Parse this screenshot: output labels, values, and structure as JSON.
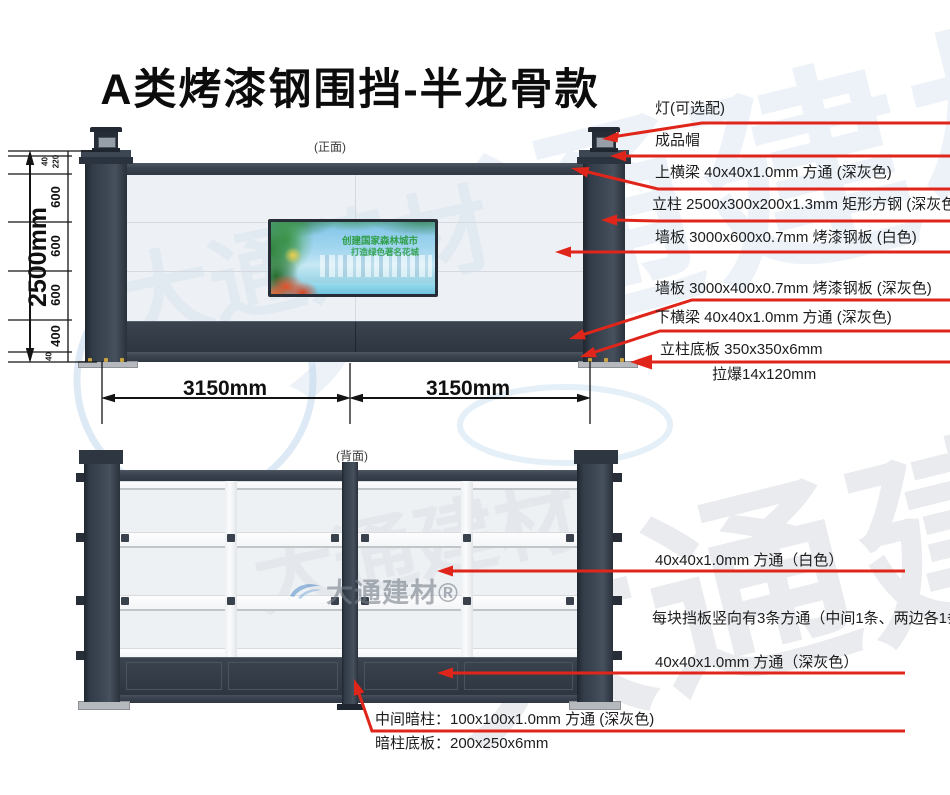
{
  "title": "A类烤漆钢围挡-半龙骨款",
  "watermark_text": "大通建材",
  "front": {
    "caption": "(正面)",
    "dim_total": "2500mm",
    "segments": {
      "top40": "40",
      "top220": "220",
      "mid600a": "600",
      "mid600b": "600",
      "mid600c": "600",
      "low400": "400",
      "bot40": "40"
    },
    "panel_w1": "3150mm",
    "panel_w2": "3150mm",
    "labels": {
      "lamp": "灯(可选配)",
      "cap": "成品帽",
      "top_beam": "上横梁 40x40x1.0mm 方通 (深灰色)",
      "post": "立柱 2500x300x200x1.3mm 矩形方钢 (深灰色)",
      "wall_white": "墙板 3000x600x0.7mm 烤漆钢板 (白色)",
      "wall_gray": "墙板 3000x400x0.7mm 烤漆钢板 (深灰色)",
      "bottom_beam": "下横梁 40x40x1.0mm 方通 (深灰色)",
      "base_plate": "立柱底板 350x350x6mm",
      "anchor": "拉爆14x120mm"
    },
    "billboard": {
      "line1": "创建国家森林城市",
      "line2": "打造绿色著名花城"
    }
  },
  "back": {
    "caption": "(背面)",
    "labels": {
      "tube_white": "40x40x1.0mm 方通（白色）",
      "tube_note": "每块挡板竖向有3条方通（中间1条、两边各1条）",
      "tube_gray": "40x40x1.0mm 方通（深灰色）",
      "hidden_post": "中间暗柱：100x100x1.0mm 方通 (深灰色)",
      "hidden_post_base": "暗柱底板：200x250x6mm"
    },
    "logo": "大通建材®"
  },
  "colors": {
    "leader_red": "#e0251b",
    "post_dark_gray": "#39434f",
    "panel_white": "#edf0f4",
    "band_dark_gray": "#333b46",
    "watermark_blue": "#a9c9e6"
  }
}
